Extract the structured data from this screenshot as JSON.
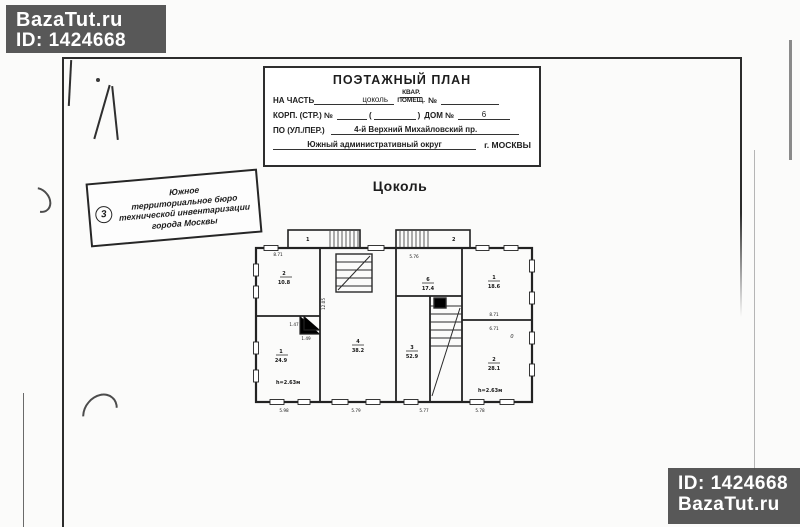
{
  "watermark_top": {
    "site": "BazaTut.ru",
    "id": "ID: 1424668"
  },
  "watermark_bottom": {
    "id": "ID: 1424668",
    "site": "BazaTut.ru"
  },
  "header": {
    "title": "ПОЭТАЖНЫЙ ПЛАН",
    "na_chast_label": "НА ЧАСТЬ",
    "na_chast_value": "цоколь",
    "kvar": "КВАР.",
    "pomesch": "ПОМЕЩ.",
    "num_label": "№",
    "korp_label": "КОРП. (СТР.) №",
    "paren_open": "(",
    "paren_close": ")",
    "dom_label": "ДОМ №",
    "dom_value": "6",
    "street_label": "ПО (УЛ./ПЕР.)",
    "street_value": "4-й Верхний Михайловский пр.",
    "okrug": "Южный административный округ",
    "city": "г. МОСКВЫ"
  },
  "stamp": {
    "number": "3",
    "line1": "Южное",
    "line2": "территориальное бюро",
    "line3": "технической инвентаризации",
    "line4": "города Москвы"
  },
  "plan": {
    "title": "Цоколь",
    "porch1": "1",
    "porch2": "2",
    "rooms": {
      "lt": {
        "num": "2",
        "area": "10.8"
      },
      "lb": {
        "num": "1",
        "area": "24.9"
      },
      "mid": {
        "num": "4",
        "area": "38.2"
      },
      "c_top": {
        "num": "6",
        "area": "17.4"
      },
      "c_bot": {
        "num": "3",
        "area": "52.9"
      },
      "rt": {
        "num": "1",
        "area": "18.6"
      },
      "rb": {
        "num": "2",
        "area": "28.1"
      }
    },
    "dims": {
      "top_left": "8.71",
      "top_mid": "5.76",
      "notch1": "1.47",
      "notch2": "1.49",
      "left_v": "12.05",
      "right_up": "8.71",
      "right_dn": "6.71",
      "zero": "0",
      "b1": "5.98",
      "b2": "5.79",
      "b3": "5.77",
      "b4": "5.78",
      "h_left": "h=2.63м",
      "h_right": "h=2.63м"
    }
  }
}
